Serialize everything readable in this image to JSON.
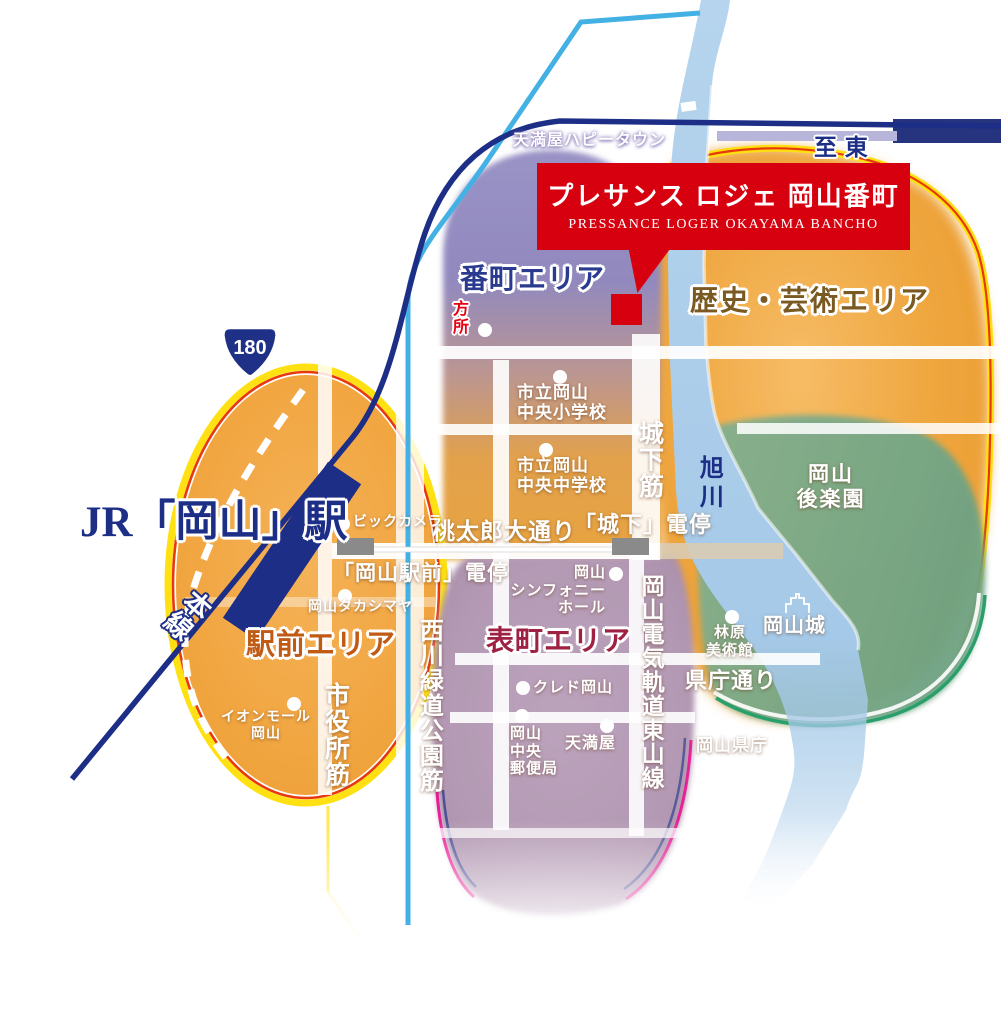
{
  "banner": {
    "title": "プレサンス ロジェ 岡山番町",
    "subtitle": "PRESSANCE  LOGER OKAYAMA BANCHO"
  },
  "areas": {
    "bancho": "番町エリア",
    "rekishi_geijutsu": "歴史・芸術エリア",
    "ekimae": "駅前エリア",
    "omotecho": "表町エリア"
  },
  "station": {
    "jr_okayama": "JR「岡山」駅",
    "sanyo_line_partial": "本線"
  },
  "route_badge": "180",
  "tram": {
    "okayama_ekimae_stop": "「岡山駅前」電停",
    "shiroshita_stop": "「城下」電停"
  },
  "roads": {
    "momotaro": "桃太郎大通り",
    "shiyakusho": "市役所筋",
    "nishigawa": "西川緑道公園筋",
    "shiroshita": "城下筋",
    "kencho_dori": "県庁通り",
    "higashiyama": "岡山電気軌道東山線"
  },
  "river": "旭川",
  "landmarks": {
    "happytown": "天満屋ハピータウン",
    "bic_camera": "ビックカメラ",
    "takashimaya": "岡山タカシマヤ",
    "aeon": "イオンモール\n岡山",
    "elementary": "市立岡山\n中央小学校",
    "junior_high": "市立岡山\n中央中学校",
    "symphony": "岡山\nシンフォニー\nホール",
    "cred": "クレド岡山",
    "post_office": "岡山\n中央\n郵便局",
    "tenmaya": "天満屋",
    "hayashibara": "林原\n美術館",
    "okayama_castle": "岡山城",
    "korakuen": "岡山\n後楽園",
    "prefectural_office": "岡山県庁"
  },
  "partial_labels": {
    "hidden_poi": "方\n所",
    "direction_east": "至 東"
  },
  "colors": {
    "banner_red": "#D7000F",
    "navy": "#1D2E87",
    "area_orange": "#EFA23C",
    "bancho_purple": "#9189BE",
    "omotecho_mauve": "#B399B3",
    "korakuen_green": "#7EA989",
    "river_blue": "#A9CCE9",
    "rim_yellow": "#FFE012",
    "rim_red": "#E8380D",
    "tsuyama_cyan": "#44B1E4"
  }
}
